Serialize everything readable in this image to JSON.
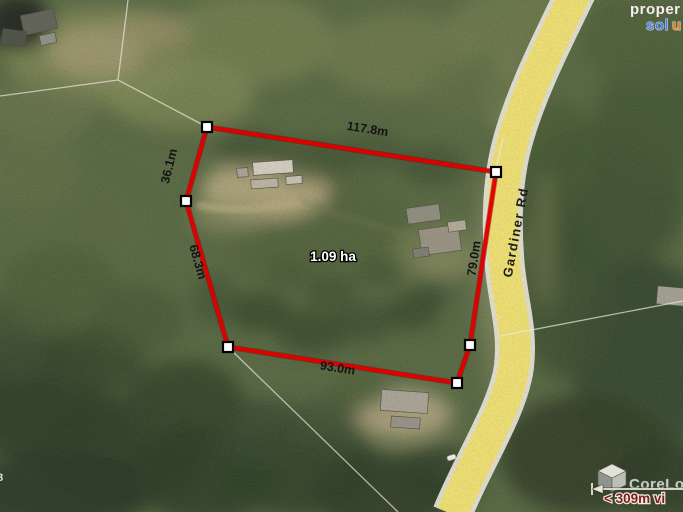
{
  "watermark": {
    "line1": "proper",
    "line2_blue": "sol",
    "line2_orange": "u"
  },
  "parcel": {
    "area_label": "1.09 ha",
    "dim_top": "117.8m",
    "dim_upper_left": "36.1m",
    "dim_left": "68.3m",
    "dim_right": "79.0m",
    "dim_bottom": "93.0m"
  },
  "road": {
    "name": "Gardiner Rd"
  },
  "branding": {
    "logo_text": "CoreLog",
    "scale_text": "< 309m vi"
  },
  "edge_label": "8",
  "colors": {
    "boundary": "#e00000",
    "road_fill": "#f1e170",
    "road_casing": "#e9e6d8",
    "scale_text": "#7c1d1a",
    "watermark_blue": "#4a7be0",
    "watermark_orange": "#e08826"
  }
}
